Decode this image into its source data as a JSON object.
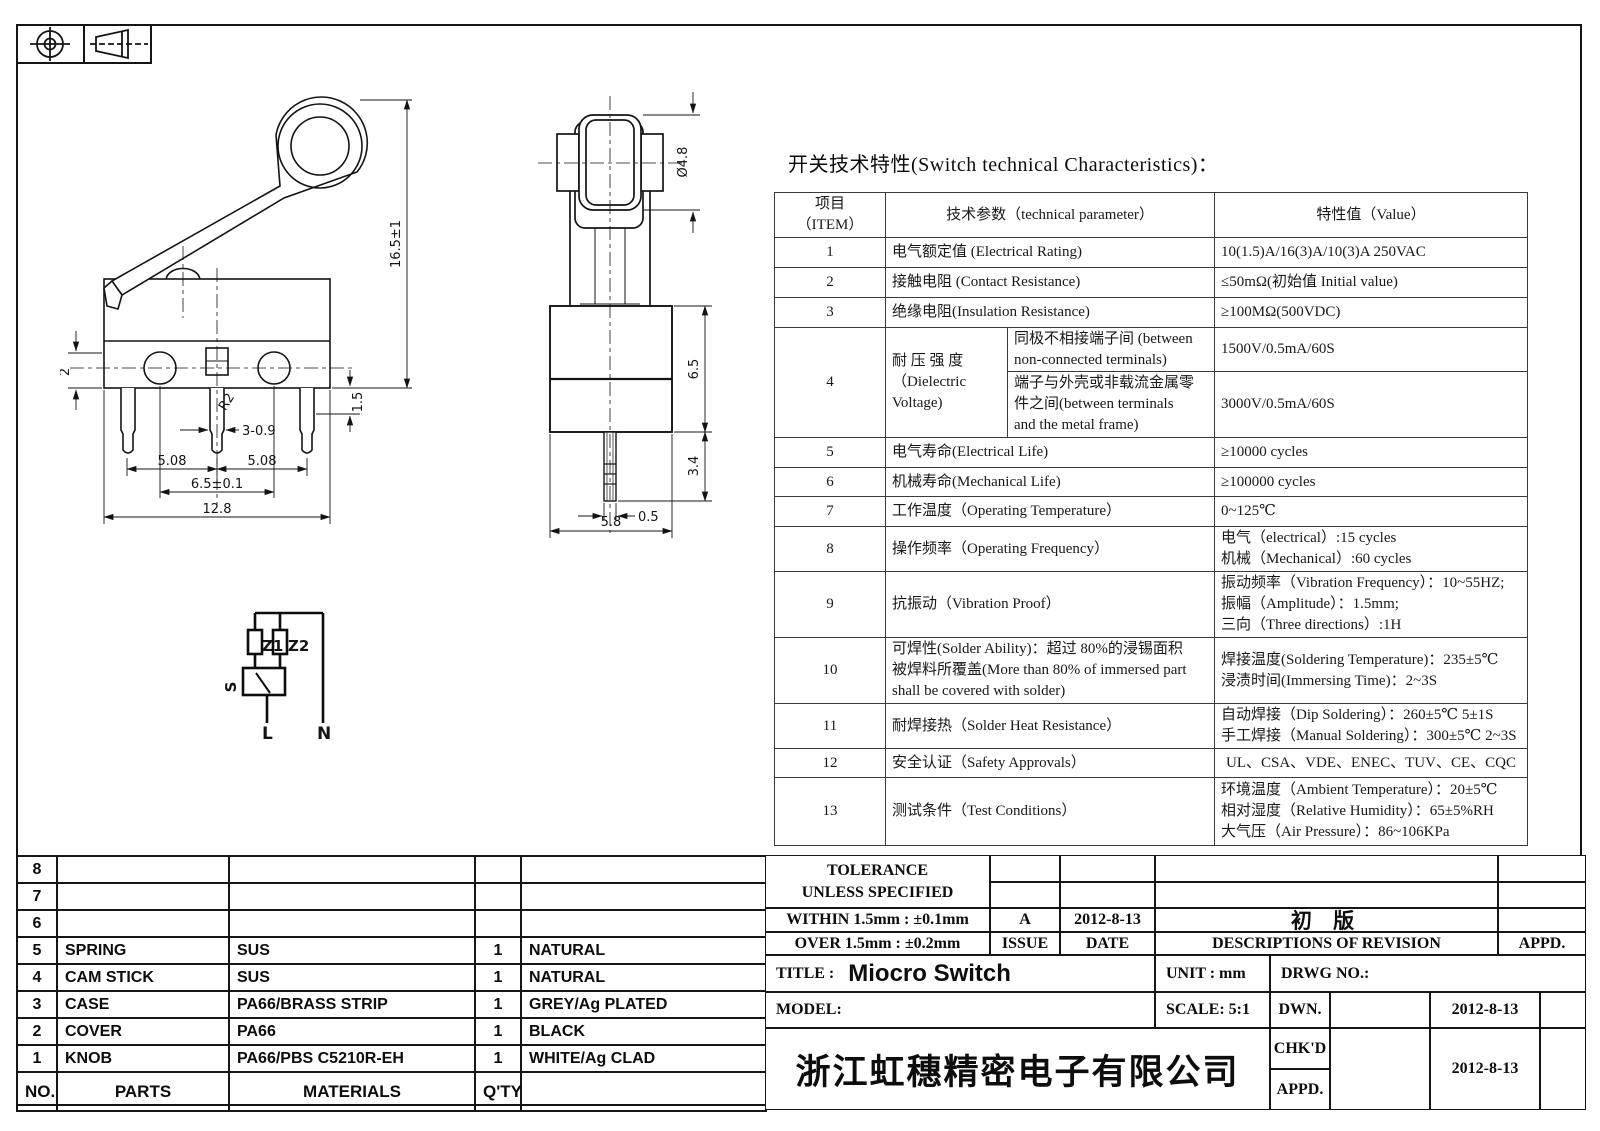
{
  "spec": {
    "title": "开关技术特性(Switch technical Characteristics)：",
    "header": {
      "item1": "项目",
      "item2": "（ITEM）",
      "param": "技术参数（technical parameter）",
      "value": "特性值（Value）"
    },
    "r1": {
      "no": "1",
      "p": "电气额定值 (Electrical Rating)",
      "v": "10(1.5)A/16(3)A/10(3)A  250VAC"
    },
    "r2": {
      "no": "2",
      "p": "接触电阻 (Contact  Resistance)",
      "v": "≤50mΩ(初始值 Initial value)"
    },
    "r3": {
      "no": "3",
      "p": "绝缘电阻(Insulation Resistance)",
      "v": "≥100MΩ(500VDC)"
    },
    "r4": {
      "no": "4",
      "p1": "耐 压 强 度",
      "p2": "（Dielectric",
      "p3": "Voltage)",
      "s1a": "同极不相接端子间 (between",
      "s1b": "non-connected terminals)",
      "v1": "1500V/0.5mA/60S",
      "s2a": "端子与外壳或非载流金属零",
      "s2b": "件之间(between terminals",
      "s2c": "and the metal frame)",
      "v2": "3000V/0.5mA/60S"
    },
    "r5": {
      "no": "5",
      "p": "电气寿命(Electrical Life)",
      "v": "≥10000 cycles"
    },
    "r6": {
      "no": "6",
      "p": "机械寿命(Mechanical Life)",
      "v": "≥100000 cycles"
    },
    "r7": {
      "no": "7",
      "p": "工作温度（Operating Temperature）",
      "v": "0~125℃"
    },
    "r8": {
      "no": "8",
      "p": "操作频率（Operating Frequency）",
      "v1": "电气（electrical）:15 cycles",
      "v2": "机械（Mechanical）:60 cycles"
    },
    "r9": {
      "no": "9",
      "p": "抗振动（Vibration Proof）",
      "v1": "振动频率（Vibration Frequency）：10~55HZ;",
      "v2": "振幅（Amplitude）：1.5mm;",
      "v3": "三向（Three directions）:1H"
    },
    "r10": {
      "no": "10",
      "p1": "可焊性(Solder Ability)：超过 80%的浸锡面积",
      "p2": "被焊料所覆盖(More than 80% of immersed part",
      "p3": "shall be covered with solder)",
      "v1": "焊接温度(Soldering Temperature)：235±5℃",
      "v2": "浸渍时间(Immersing Time)：2~3S"
    },
    "r11": {
      "no": "11",
      "p": "耐焊接热（Solder Heat Resistance）",
      "v1": "自动焊接（Dip Soldering）：260±5℃ 5±1S",
      "v2": "手工焊接（Manual Soldering）：300±5℃ 2~3S"
    },
    "r12": {
      "no": "12",
      "p": "安全认证（Safety Approvals）",
      "v": "UL、CSA、VDE、ENEC、TUV、CE、CQC"
    },
    "r13": {
      "no": "13",
      "p": "测试条件（Test Conditions）",
      "v1": "环境温度（Ambient Temperature）：20±5℃",
      "v2": "相对湿度（Relative Humidity）：65±5%RH",
      "v3": "大气压（Air Pressure）：86~106KPa"
    }
  },
  "parts": {
    "header": {
      "no": "NO.",
      "parts": "PARTS",
      "materials": "MATERIALS",
      "qty": "Q'TY",
      "color": ""
    },
    "r8": {
      "no": "8",
      "name": "",
      "mat": "",
      "qty": "",
      "color": ""
    },
    "r7": {
      "no": "7",
      "name": "",
      "mat": "",
      "qty": "",
      "color": ""
    },
    "r6": {
      "no": "6",
      "name": "",
      "mat": "",
      "qty": "",
      "color": ""
    },
    "r5": {
      "no": "5",
      "name": "SPRING",
      "mat": "SUS",
      "qty": "1",
      "color": "NATURAL"
    },
    "r4": {
      "no": "4",
      "name": "CAM STICK",
      "mat": "SUS",
      "qty": "1",
      "color": "NATURAL"
    },
    "r3": {
      "no": "3",
      "name": "CASE",
      "mat": "PA66/BRASS STRIP",
      "qty": "1",
      "color": "GREY/Ag PLATED"
    },
    "r2": {
      "no": "2",
      "name": "COVER",
      "mat": "PA66",
      "qty": "1",
      "color": "BLACK"
    },
    "r1": {
      "no": "1",
      "name": "KNOB",
      "mat": "PA66/PBS C5210R-EH",
      "qty": "1",
      "color": "WHITE/Ag CLAD"
    }
  },
  "titleblock": {
    "tolerance1": "TOLERANCE",
    "tolerance2": "UNLESS  SPECIFIED",
    "within": "WITHIN 1.5mm : ±0.1mm",
    "over": "OVER 1.5mm : ±0.2mm",
    "issue_value": "A",
    "issue_label": "ISSUE",
    "date_value": "2012-8-13",
    "date_label": "DATE",
    "revision_value": "初  版",
    "revision_label": "DESCRIPTIONS  OF  REVISION",
    "appd_label": "APPD.",
    "title_label": "TITLE :",
    "title_value": "Miocro Switch",
    "unit_label": "UNIT :  mm",
    "drwg_label": "DRWG  NO.:",
    "model_label": "MODEL:",
    "scale_label": "SCALE:  5:1",
    "dwn_label": "DWN.",
    "dwn_date": "2012-8-13",
    "chkd_label": "CHK'D",
    "appd_row_label": "APPD.",
    "chkd_date": "2012-8-13",
    "company": "浙江虹穗精密电子有限公司"
  },
  "dims": {
    "front": {
      "height": "16.5±1",
      "left": "2",
      "right": "1.5",
      "radius": "R2",
      "pin": "3-0.9",
      "pitch1": "5.08",
      "pitch2": "5.08",
      "span": "6.5±0.1",
      "width": "12.8"
    },
    "side": {
      "dia": "Ø4.8",
      "body_h": "6.5",
      "term_l": "3.4",
      "term_w": "0.5",
      "body_w": "5.8"
    },
    "circuit": {
      "z1": "Z1",
      "z2": "Z2",
      "s": "S",
      "l": "L",
      "n": "N"
    }
  }
}
